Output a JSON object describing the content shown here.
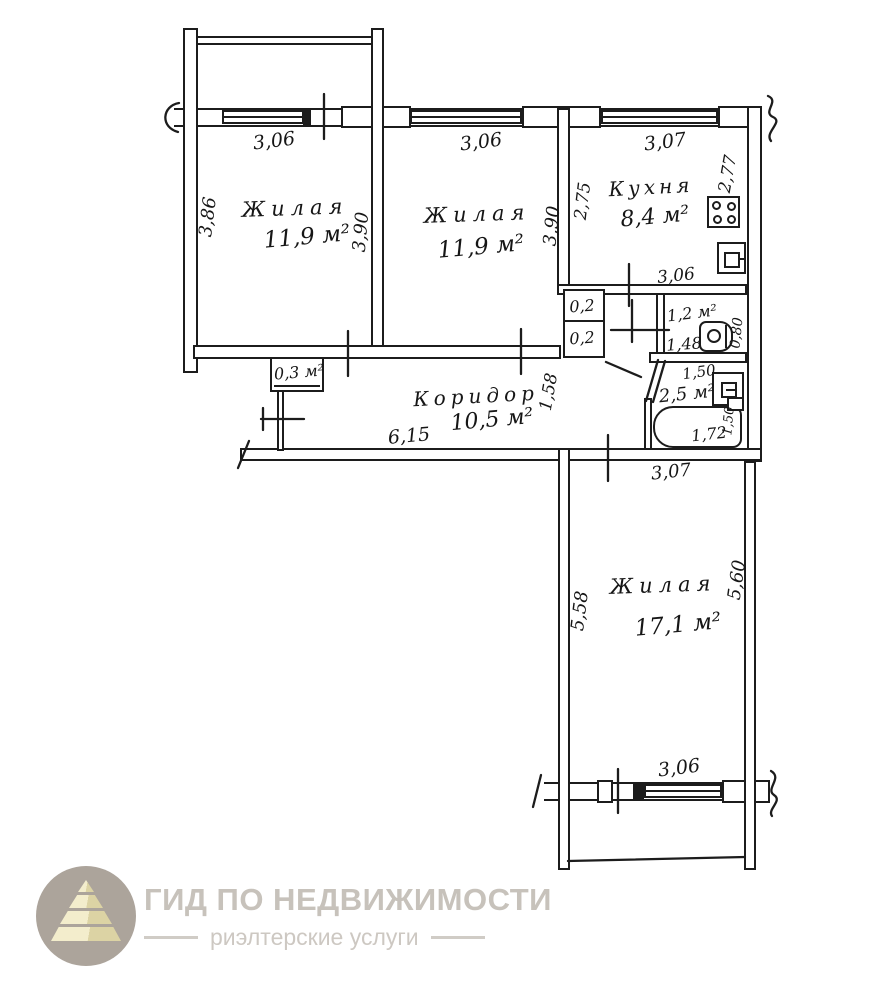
{
  "meta": {
    "type": "apartment floor plan scan"
  },
  "plan": {
    "room1": {
      "name": "Жилая",
      "area": "11,9 м²",
      "window": "3,06",
      "side": "3,86",
      "depth": "3,90"
    },
    "room2": {
      "name": "Жилая",
      "area": "11,9 м²",
      "window": "3,06",
      "depth": "3,90"
    },
    "kitchen": {
      "name": "Кухня",
      "area": "8,4 м²",
      "window": "3,07",
      "left": "2,75",
      "right": "2,77",
      "bottom": "3,06"
    },
    "toilet": {
      "area": "1,2 м²",
      "width": "1,48",
      "depth": "0,80"
    },
    "bathroom": {
      "area": "2,5 м²",
      "top": "1,50",
      "tub": "1,72",
      "side": "1,50"
    },
    "closets": {
      "upper": "0,2",
      "lower": "0,2",
      "hall": "0,3 м²"
    },
    "corridor": {
      "name": "Коридор",
      "area": "10,5 м²",
      "length": "6,15",
      "width": "1,58"
    },
    "room3": {
      "name": "Жилая",
      "area": "17,1 м²",
      "top": "3,07",
      "left": "5,58",
      "right": "5,60",
      "window": "3,06"
    }
  },
  "brand": {
    "title": "ГИД ПО НЕДВИЖИМОСТИ",
    "subtitle": "риэлтерские услуги"
  },
  "icons": {
    "stove": "square with 4 burner circles",
    "kitchen_sink": "square-in-square sink",
    "toilet": "rounded tank with round bowl",
    "bath_sink": "square-in-square sink",
    "bathtub": "rounded rectangle tub",
    "logo_pyramid": "tiered pyramid inside circle"
  },
  "colors": {
    "line": "#1c1c1c",
    "paper": "#ffffff",
    "logo_circle": "#aca49b",
    "logo_pyramid_light": "#f3edcc",
    "logo_pyramid_dark": "#dcd3a4",
    "logo_title_text": "#c7c2bb",
    "logo_subtitle_text": "#cdc8c2"
  }
}
